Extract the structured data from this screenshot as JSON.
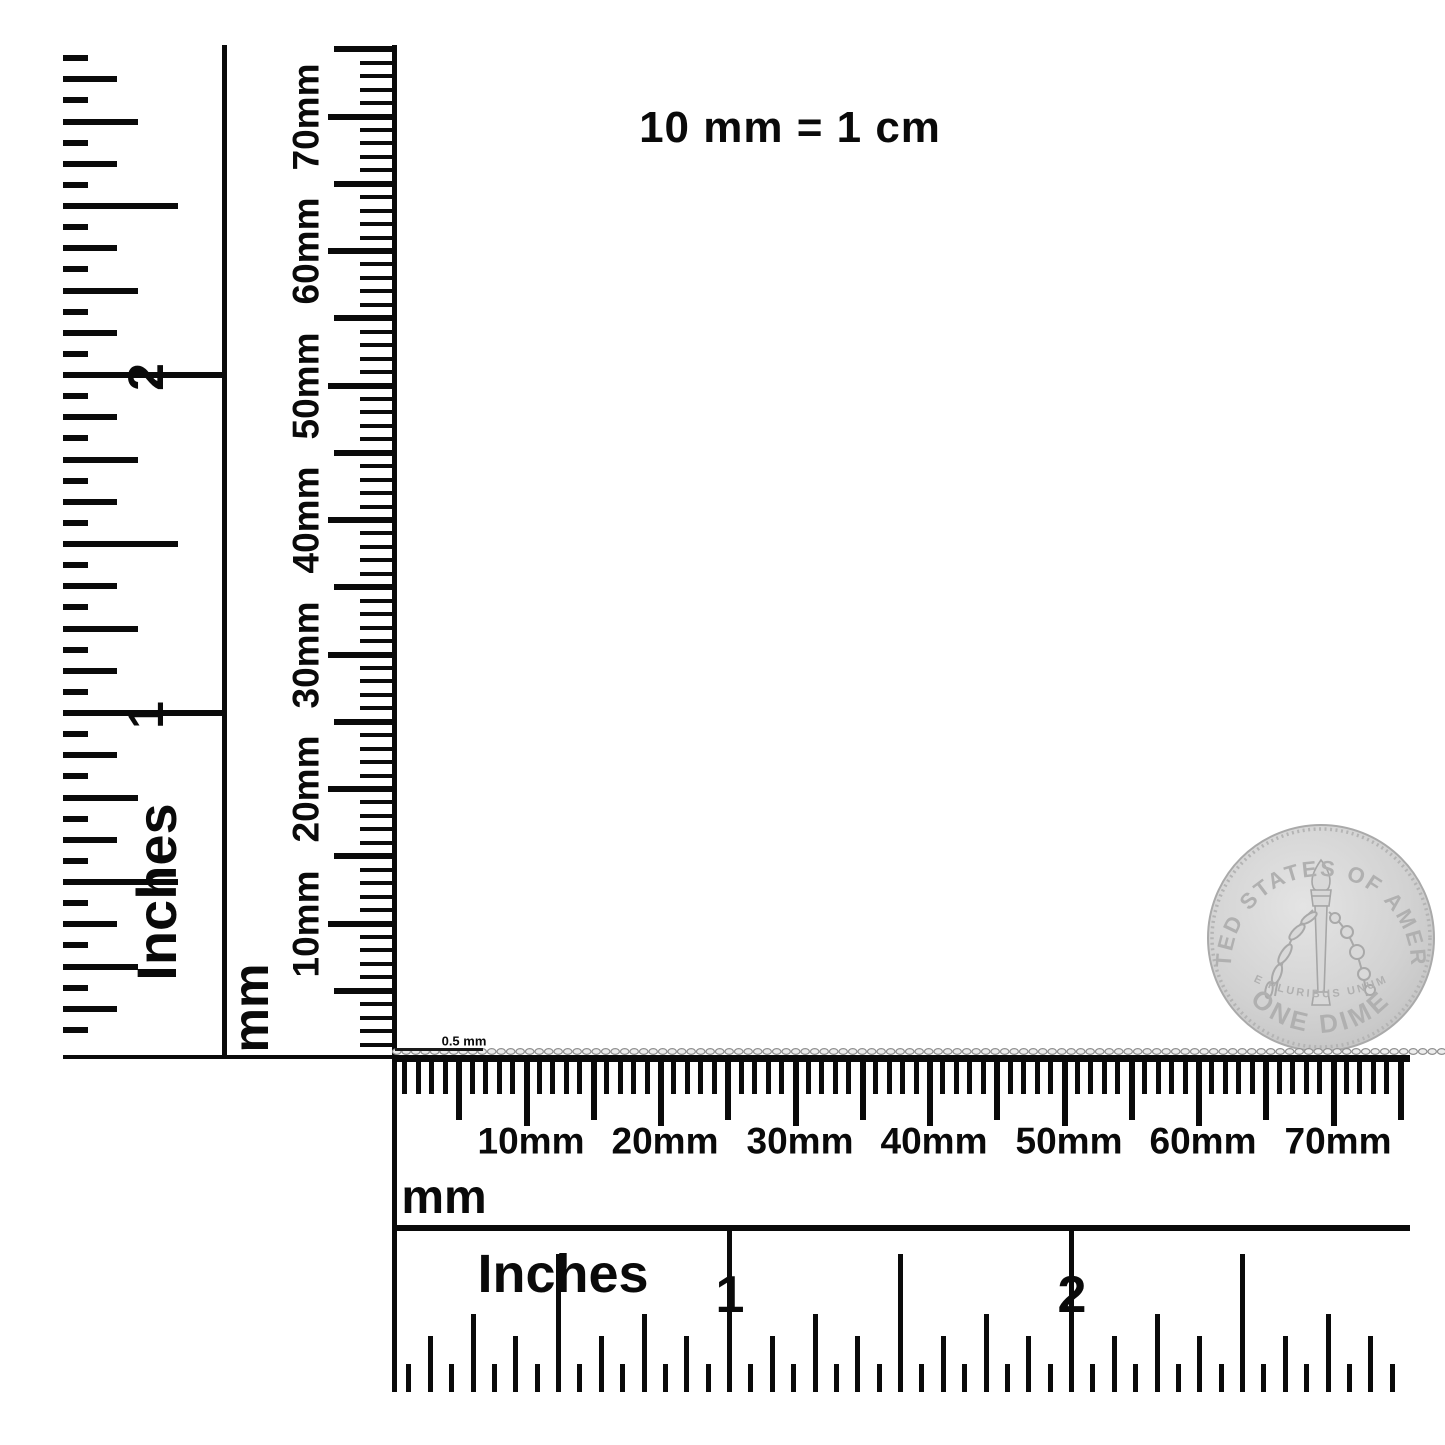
{
  "note": {
    "text": "10 mm = 1 cm"
  },
  "chain": {
    "size_label": "0.5 mm"
  },
  "left_inch_ruler": {
    "unit_label": "Inches",
    "numbers": [
      "1",
      "2"
    ]
  },
  "left_mm_ruler": {
    "unit_label": "mm",
    "labels": [
      "10mm",
      "20mm",
      "30mm",
      "40mm",
      "50mm",
      "60mm",
      "70mm"
    ]
  },
  "bottom_mm_ruler": {
    "unit_label": "mm",
    "labels": [
      "10mm",
      "20mm",
      "30mm",
      "40mm",
      "50mm",
      "60mm",
      "70mm"
    ]
  },
  "bottom_inch_ruler": {
    "unit_label": "Inches",
    "numbers": [
      "1",
      "2"
    ]
  },
  "coin": {
    "top_text": "UNITED STATES OF AMERICA",
    "motto": "E PLURIBUS UNUM",
    "bottom_text": "ONE DIME"
  },
  "colors": {
    "ink": "#0a0a0a",
    "coin_silver": "#cdcdcd",
    "chain_link": "#8f8f8f"
  }
}
